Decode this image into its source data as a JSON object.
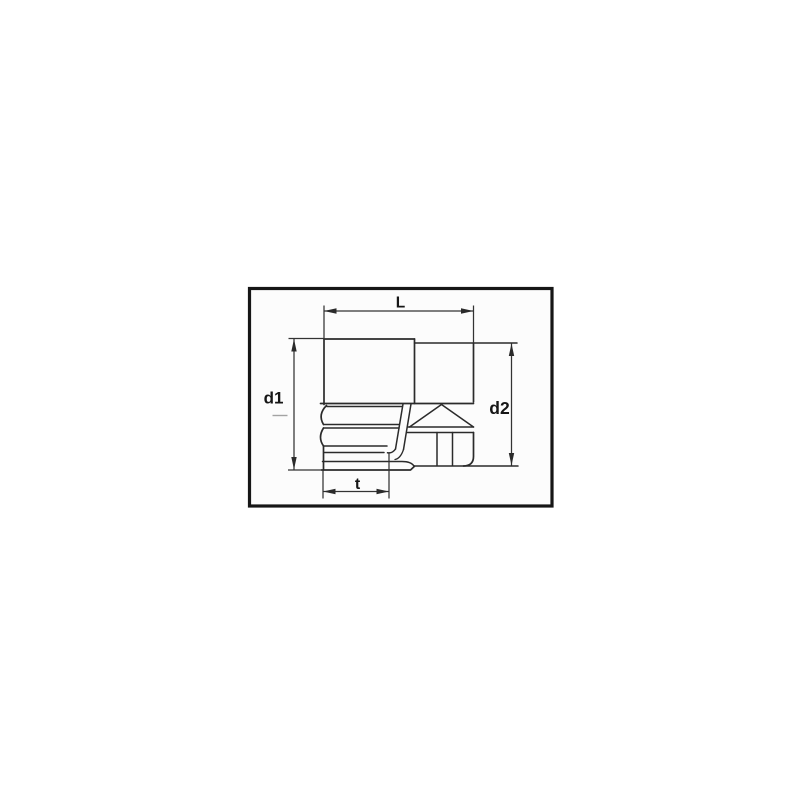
{
  "figure": {
    "name": "socket-dimension-drawing",
    "description": "Side view technical drawing of a socket wrench insert with section details",
    "dimension_labels": {
      "length": "L",
      "diameter_left": "d1",
      "diameter_right": "d2",
      "opening_depth": "t"
    }
  },
  "colors": {
    "background": "#ffffff",
    "panel": "#fcfcfc",
    "border": "#161616",
    "line": "#2b2b2b",
    "dimension": "#333333",
    "arrow": "#2a2a2a",
    "text": "#161616",
    "centerline": "#a3a3a3"
  }
}
